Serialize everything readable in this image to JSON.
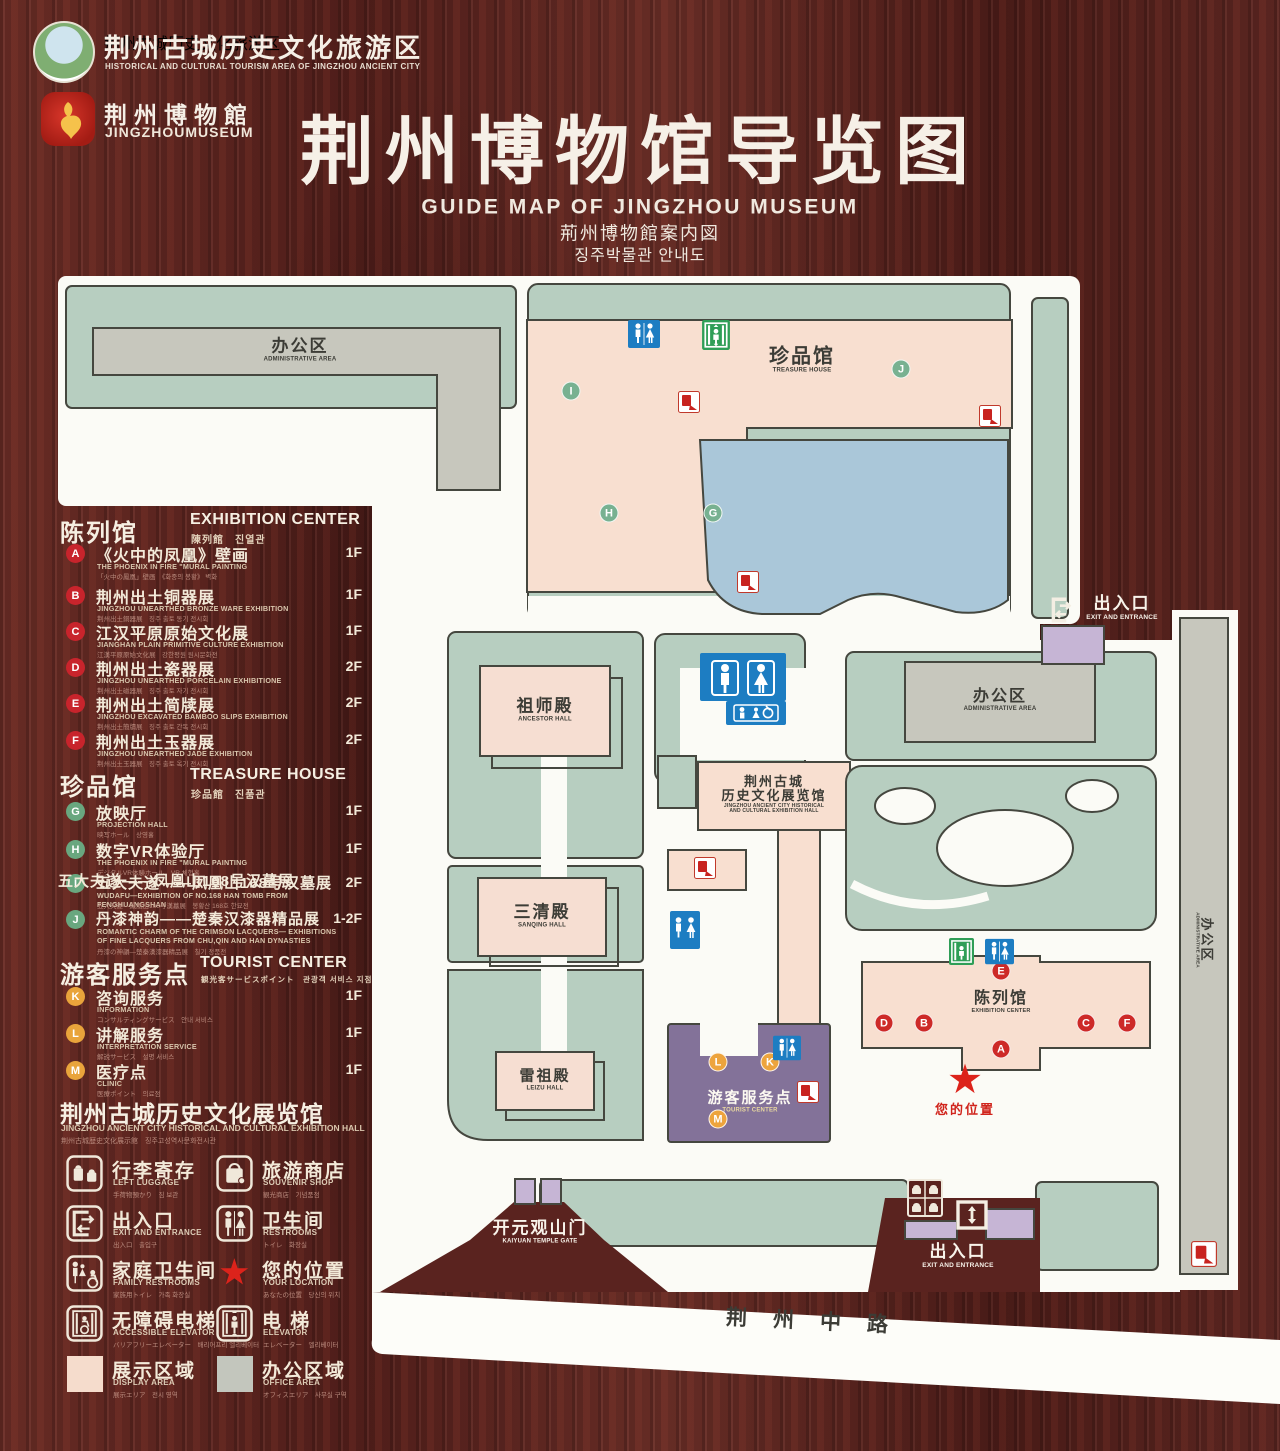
{
  "header": {
    "org": {
      "cn": "荆州古城历史文化旅游区",
      "en": "HISTORICAL AND CULTURAL TOURISM AREA OF JINGZHOU ANCIENT CITY"
    },
    "museum": {
      "cn": "荆州博物館",
      "en": "JINGZHOUMUSEUM"
    },
    "title": "荆州博物馆导览图",
    "subtitle_en": "GUIDE MAP OF JINGZHOU MUSEUM",
    "subtitle_ja": "荊州博物館案内図",
    "subtitle_ko": "징주박물관 안내도"
  },
  "legend": {
    "sections": [
      {
        "title_cn": "陈列馆",
        "title_en": "EXHIBITION CENTER",
        "title_sub": "陳列館　진열관",
        "items": [
          {
            "key": "A",
            "cn": "《火中的凤凰》壁画",
            "en": "THE PHOENIX IN FIRE \"MURAL PAINTING",
            "sub": "「火中の鳳凰」壁画　《화중의 봉황》 벽화",
            "floor": "1F"
          },
          {
            "key": "B",
            "cn": "荆州出土铜器展",
            "en": "JINGZHOU UNEARTHED BRONZE WARE EXHIBITION",
            "sub": "荆州出土銅器展　징주 출토 동기 전시회",
            "floor": "1F"
          },
          {
            "key": "C",
            "cn": "江汉平原原始文化展",
            "en": "JIANGHAN PLAIN PRIMITIVE CULTURE EXHIBITION",
            "sub": "江漢平原原始文化展　강한평원 원시문화전",
            "floor": "1F"
          },
          {
            "key": "D",
            "cn": "荆州出土瓷器展",
            "en": "JINGZHOU UNEARTHED PORCELAIN EXHIBITIONE",
            "sub": "荆州出土磁器展　징주 출토 자기 전시회",
            "floor": "2F"
          },
          {
            "key": "E",
            "cn": "荆州出土简牍展",
            "en": "JINGZHOU EXCAVATED BAMBOO SLIPS EXHIBITION",
            "sub": "荆州出土簡牘展　징주 출토 간독 전시회",
            "floor": "2F"
          },
          {
            "key": "F",
            "cn": "荆州出土玉器展",
            "en": "JINGZHOU UNEARTHED JADE EXHIBITION",
            "sub": "荆州出土玉器展　징주 출토 옥기 전시회",
            "floor": "2F"
          }
        ]
      },
      {
        "title_cn": "珍品馆",
        "title_en": "TREASURE HOUSE",
        "title_sub": "珍品館　진품관",
        "items": [
          {
            "key": "G",
            "cn": "放映厅",
            "en": "PROJECTION HALL",
            "sub": "映写ホール　상영홀",
            "floor": "1F"
          },
          {
            "key": "H",
            "cn": "数字VR体验厅",
            "en": "THE PHOENIX IN FIRE \"MURAL PAINTING",
            "sub": "デジタルVR体験ホール　VR 체험홀",
            "floor": "1F"
          },
          {
            "key": "I",
            "cn": "五大夫遂——凤凰山168号汉墓展",
            "en": "WUDAFU—EXHIBITION OF NO.168 HAN TOMB FROM FENGHUANGSHAN",
            "sub": "五大夫遂—鳳凰山168号漢墓展　봉황산 168호 한묘전",
            "floor": "2F"
          },
          {
            "key": "J",
            "cn": "丹漆神韵——楚秦汉漆器精品展",
            "en": "ROMANTIC CHARM OF THE CRIMSON LACQUERS— EXHIBITIONS OF FINE LACQUERS FROM CHU,QIN AND HAN DYNASTIES",
            "sub": "丹漆の神韻—楚秦漢漆器精品展　칠기 정품전",
            "floor": "1-2F"
          }
        ]
      },
      {
        "title_cn": "游客服务点",
        "title_en": "TOURIST CENTER",
        "title_sub": "観光客サービスポイント　관광객 서비스 지점",
        "items": [
          {
            "key": "K",
            "cn": "咨询服务",
            "en": "INFORMATION",
            "sub": "コンサルティングサービス　안내 서비스",
            "floor": "1F"
          },
          {
            "key": "L",
            "cn": "讲解服务",
            "en": "INTERPRETATION SERVICE",
            "sub": "解説サービス　설명 서비스",
            "floor": "1F"
          },
          {
            "key": "M",
            "cn": "医疗点",
            "en": "CLINIC",
            "sub": "医療ポイント　의료점",
            "floor": "1F"
          }
        ]
      }
    ],
    "hall_note": {
      "cn": "荆州古城历史文化展览馆",
      "en": "JINGZHOU ANCIENT CITY HISTORICAL AND CULTURAL EXHIBITION HALL",
      "sub": "荆州古城歴史文化展示館　징주고성역사문화전시관"
    },
    "facilities": [
      {
        "cn": "行李寄存",
        "en": "LEFT LUGGAGE",
        "sub": "手荷物預かり　짐 보관"
      },
      {
        "cn": "旅游商店",
        "en": "SOUVENIR SHOP",
        "sub": "観光商店　기념품점"
      },
      {
        "cn": "出入口",
        "en": "EXIT AND ENTRANCE",
        "sub": "出入口　출입구"
      },
      {
        "cn": "卫生间",
        "en": "RESTROOMS",
        "sub": "トイレ　화장실"
      },
      {
        "cn": "家庭卫生间",
        "en": "FAMILY RESTROOMS",
        "sub": "家族用トイレ　가족 화장실"
      },
      {
        "cn": "您的位置",
        "en": "YOUR LOCATION",
        "sub": "あなたの位置　당신의 위치"
      },
      {
        "cn": "无障碍电梯",
        "en": "ACCESSIBLE ELEVATOR",
        "sub": "バリアフリーエレベーター　배리어프리 엘리베이터"
      },
      {
        "cn": "电 梯",
        "en": "ELEVATOR",
        "sub": "エレベーター　엘리베이터"
      },
      {
        "cn": "展示区域",
        "en": "DISPLAY AREA",
        "sub": "展示エリア　전시 영역"
      },
      {
        "cn": "办公区域",
        "en": "OFFICE AREA",
        "sub": "オフィスエリア　사무실 구역"
      }
    ]
  },
  "map": {
    "admin": {
      "cn": "办公区",
      "en": "ADMINISTRATIVE AREA"
    },
    "treasure": {
      "cn": "珍品馆",
      "en": "TREASURE HOUSE"
    },
    "ancestor": {
      "cn": "祖师殿",
      "en": "ANCESTOR HALL"
    },
    "sanqing": {
      "cn": "三清殿",
      "en": "SANQING HALL"
    },
    "leizu": {
      "cn": "雷祖殿",
      "en": "LEIZU HALL"
    },
    "exh_hall": {
      "cn1": "荆州古城",
      "cn2": "历史文化展览馆",
      "en1": "JINGZHOU ANCIENT CITY HISTORICAL",
      "en2": "AND CULTURAL EXHIBITION HALL"
    },
    "tourist": {
      "cn": "游客服务点",
      "en": "TOURIST CENTER"
    },
    "exh_center": {
      "cn": "陈列馆",
      "en": "EXHIBITION CENTER"
    },
    "your_location": "您的位置",
    "exit": {
      "cn": "出入口",
      "en": "EXIT AND ENTRANCE"
    },
    "gate": {
      "cn": "开元观山门",
      "en": "KAIYUAN TEMPLE GATE"
    },
    "road": "荆州中路",
    "marker": {
      "a": "A",
      "b": "B",
      "c": "C",
      "d": "D",
      "e": "E",
      "f": "F",
      "g": "G",
      "h": "H",
      "i": "I",
      "j": "J",
      "k": "K",
      "l": "L",
      "m": "M"
    }
  },
  "colors": {
    "wood": "#5a231f",
    "map_green": "#b7cec0",
    "building_pink": "#f8dfd0",
    "office_gray": "#c7c7bd",
    "lake_blue": "#aac7d9",
    "tourist_purple": "#837299",
    "gate_lavender": "#c6b5d5",
    "marker_red": "#cd2a28",
    "marker_green": "#78b191",
    "marker_orange": "#eda43d",
    "badge_red": "#c8242c"
  }
}
